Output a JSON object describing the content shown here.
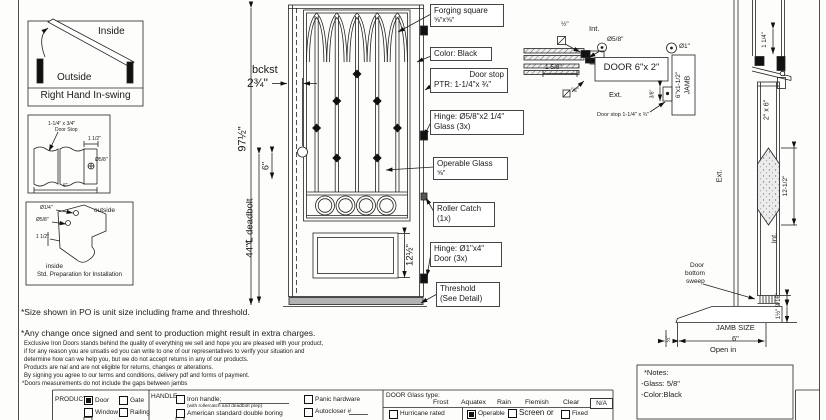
{
  "swing": {
    "inside": "Inside",
    "outside": "Outside",
    "title": "Right Hand In-swing"
  },
  "stop": {
    "l1": "1-1/4\" x 3/4\"",
    "l2": "Door Stop",
    "d1": "1 1/2\"",
    "d2": "Ø5/8\"",
    "d3": "6\""
  },
  "prep": {
    "d1": "Ø1/4\"",
    "outside": "outside",
    "d2": "Ø5/8\"",
    "d3": "1 1/2\"",
    "inside": "inside",
    "title": "Std. Preparation for Installation"
  },
  "elev": {
    "height": "97½\"",
    "bckst": "bckst",
    "bckst_dim": "2¾\"",
    "six": "6\"",
    "deadbolt": "44\"℄ deadbolt",
    "panel": "12½\"",
    "co1a": "Forging square",
    "co1b": "⅝\"x⅝\"",
    "co2": "Color: Black",
    "co3a": "Door stop",
    "co3b": "PTR: 1-1/4\"x ¾\"",
    "co4a": "Hinge: Ø5/8\"x2 1/4\"",
    "co4b": "Glass (3x)",
    "co5a": "Operable Glass",
    "co5b": "⅝\"",
    "co6a": "Roller Catch",
    "co6b": "(1x)",
    "co7a": "Hinge: Ø1\"x4\"",
    "co7b": "Door (3x)",
    "co8a": "Threshold",
    "co8b": "(See Detail)"
  },
  "head": {
    "half": "½\"",
    "int": "Int.",
    "dia58": "Ø5/8\"",
    "d158": "1 5/8\"",
    "door": "DOOR 6\"x 2\"",
    "f58": "⅝\"",
    "ext": "Ext.",
    "dia1": "Ø1\"",
    "jamb": "JAMB",
    "jambsz": "6\"x1-1/2\"",
    "d38": "3/8\"",
    "stop": "Door stop 1-1/4\" x ¾\""
  },
  "sect": {
    "d114": "1 1/4\"",
    "door": "2\" x 6\"",
    "glass": "12-1/2\"",
    "ext": "Ext.",
    "int": "Int.",
    "sw1": "Door",
    "sw2": "bottom",
    "sw3": "sweep",
    "d916": "9/16\"",
    "d112": "1½\"",
    "dhalf": "½\"",
    "jamb": "JAMB SIZE",
    "six": "6\"",
    "open": "Open in"
  },
  "notes": {
    "t": "*Notes:",
    "g": "-Glass: 5/8\"",
    "c": "-Color:Black"
  },
  "disc": {
    "s1": "*Size shown in PO is unit size including frame and threshold.",
    "s2": "*Any change once signed and sent to production might result in extra charges.",
    "f1": "Exclusive Iron Doors stands behind the quality of everything we sell and hope you are pleased with your product,",
    "f2": "if for any reason you are unsatis ed you can write to one of our representatives to verify your situation and",
    "f3": "determine how can we help you, but we do not accept returns in any of our products.",
    "f4": "Products are  nal and are not eligible for returns, changes or alterations.",
    "f5": "By signing you agree to our terms and conditions, delivery pdf and forms of payment.",
    "f6": "*Doors measurements do not include the gaps between jambs"
  },
  "form": {
    "product": "PRODUCT:",
    "p1": "Door",
    "p2": "Gate",
    "p3": "Window",
    "p4": "Railing",
    "p1_checked": true,
    "p2_checked": false,
    "p3_checked": false,
    "p4_checked": false,
    "handle": "HANDLE",
    "h1": "Iron handle;",
    "h1s": "(with rollercatch and deadbolt prep)",
    "h2": "American standard double boring",
    "h3": "Panic hardware",
    "h4": "Autocloser #",
    "glass": "DOOR Glass type:",
    "g1": "Frost",
    "g2": "Aquatex",
    "g3": "Rain",
    "g4": "Flemish",
    "g5": "Clear",
    "g6": "N/A",
    "r1": "Hurricane rated",
    "r2": "Operable",
    "r3": "Screen or",
    "r4": "Fixed",
    "r2_checked": true
  }
}
